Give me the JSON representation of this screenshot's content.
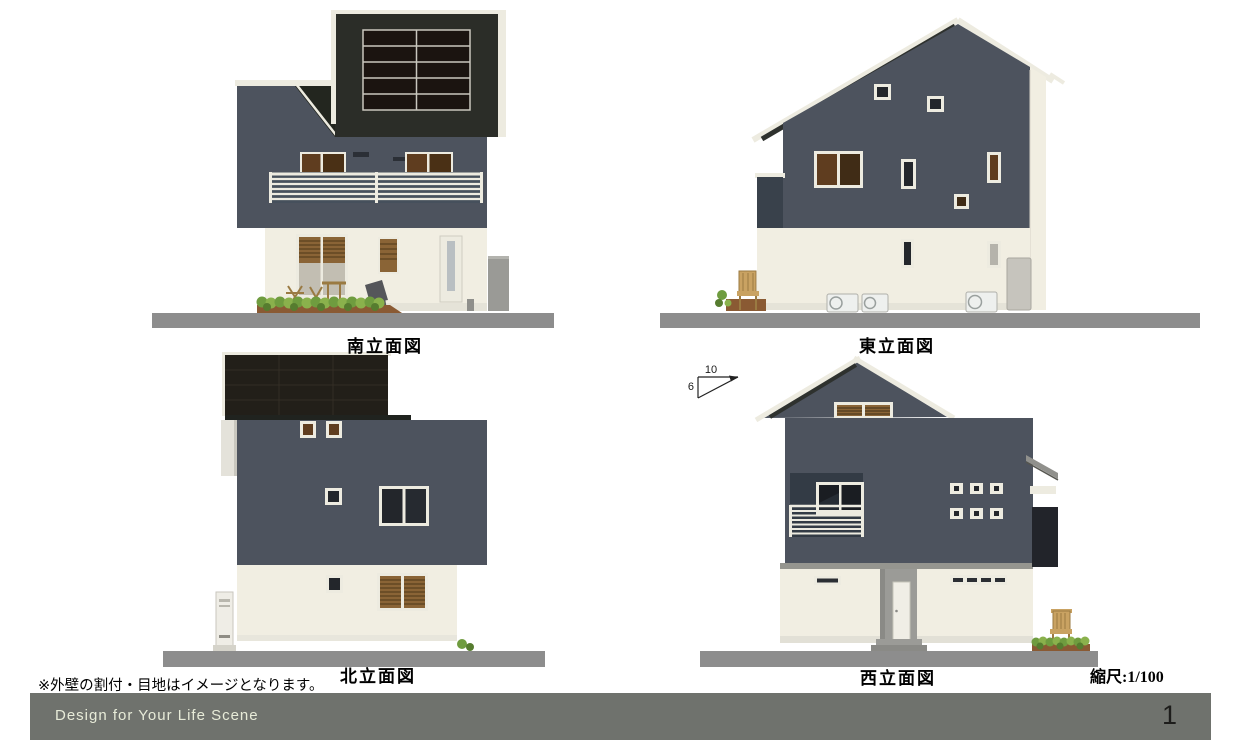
{
  "sheet": {
    "note": "※外壁の割付・目地はイメージとなります。",
    "scale_label": "縮尺:1/100",
    "pitch_indicator": {
      "run": "10",
      "rise": "6"
    }
  },
  "elevations": {
    "south": {
      "label": "南立面図"
    },
    "east": {
      "label": "東立面図"
    },
    "north": {
      "label": "北立面図"
    },
    "west": {
      "label": "西立面図"
    }
  },
  "footer": {
    "brand": "Design for Your Life Scene",
    "page_number": "1"
  },
  "colors": {
    "siding_navy": "#4d535e",
    "siding_navy_dark": "#39414b",
    "roof_charcoal": "#2b2d28",
    "solar_panel": "#1b1410",
    "solar_frame": "#c9c7be",
    "wall_cream": "#f1eee2",
    "foundation": "#e5e3d8",
    "trim_white": "#edebe0",
    "window_dark": "#23262b",
    "window_brown": "#5f3d1f",
    "louver_brown": "#8a6436",
    "ground_gray": "#8d8d8d",
    "fence_gray": "#9a9a96",
    "plant_green": "#6f9c3f",
    "plant_green_light": "#8ab14c",
    "plant_green_dark": "#567c2f",
    "planter_brown": "#8a5a33",
    "furniture_tan": "#c9a262",
    "footer_bg": "#6f726d",
    "footer_text": "#e7ebd8",
    "page_number_color": "#1d1d1b",
    "text_black": "#000000"
  }
}
